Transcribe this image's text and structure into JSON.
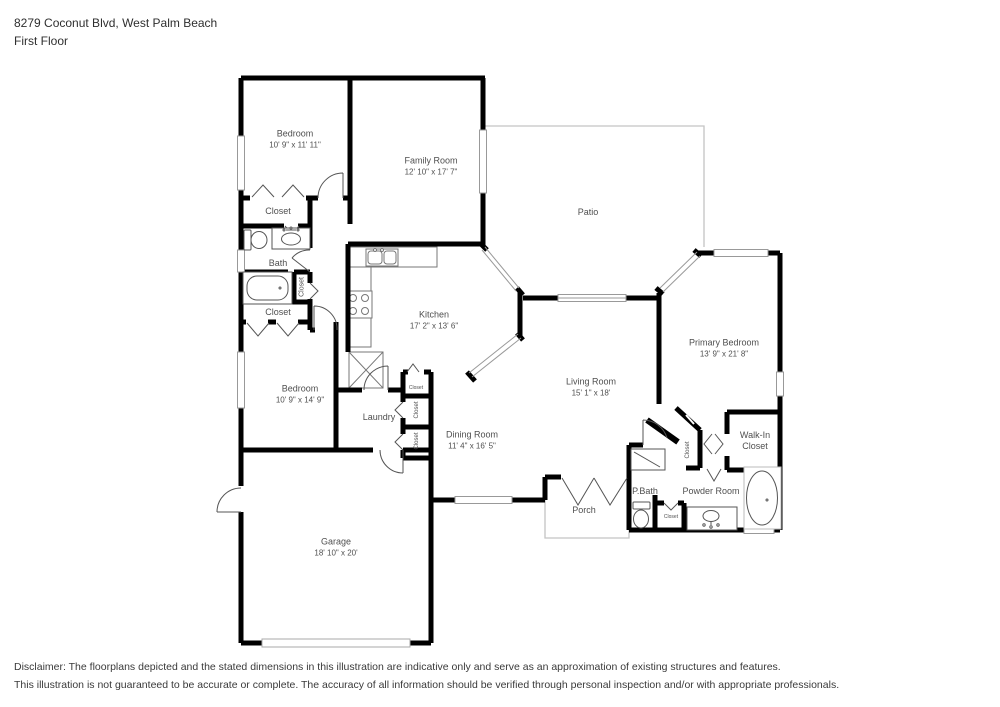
{
  "header": {
    "address": "8279 Coconut Blvd, West Palm Beach",
    "floor": "First Floor"
  },
  "rooms": {
    "bedroom1": {
      "name": "Bedroom",
      "dims": "10' 9\" x 11' 11\""
    },
    "family_room": {
      "name": "Family Room",
      "dims": "12' 10\" x 17' 7\""
    },
    "patio": {
      "name": "Patio"
    },
    "closet_bedroom1": {
      "name": "Closet"
    },
    "bath": {
      "name": "Bath"
    },
    "closet_tub": {
      "name": "Closet"
    },
    "closet_hall": {
      "name": "Closet"
    },
    "kitchen": {
      "name": "Kitchen",
      "dims": "17' 2\" x 13' 6\""
    },
    "bedroom2": {
      "name": "Bedroom",
      "dims": "10' 9\" x 14' 9\""
    },
    "laundry": {
      "name": "Laundry"
    },
    "closet_kitchen": {
      "name": "Closet"
    },
    "closet_laundry1": {
      "name": "Closet"
    },
    "closet_laundry2": {
      "name": "Closet"
    },
    "dining_room": {
      "name": "Dining Room",
      "dims": "11' 4\" x 16' 5\""
    },
    "living_room": {
      "name": "Living Room",
      "dims": "15' 1\" x 18'"
    },
    "primary_bedroom": {
      "name": "Primary Bedroom",
      "dims": "13' 9\" x 21' 8\""
    },
    "walk_in_closet": {
      "name": "Walk-In Closet"
    },
    "closet_vestibule": {
      "name": "Closet"
    },
    "p_bath": {
      "name": "P.Bath"
    },
    "powder_room": {
      "name": "Powder Room"
    },
    "closet_powder": {
      "name": "Closet"
    },
    "porch": {
      "name": "Porch"
    },
    "garage": {
      "name": "Garage",
      "dims": "18' 10\" x 20'"
    }
  },
  "footer": {
    "line1": "Disclaimer: The floorplans depicted and the stated dimensions in this illustration are indicative only and serve as an approximation of existing structures and features.",
    "line2": "This illustration is not guaranteed to be accurate or complete. The accuracy of all information should be verified through personal inspection and/or with appropriate professionals."
  },
  "icons": {
    "toilet-icon": "tank+bowl shape",
    "sink-icon": "vanity oval",
    "bathtub-icon": "rounded tub",
    "freestanding-tub-icon": "oval tub",
    "shower-icon": "square with diagonal",
    "stove-icon": "4 burners",
    "kitchen-sink-icon": "double basin",
    "washer-icon": "box with X",
    "door-arc-icon": "quarter-circle swing",
    "window-icon": "white gap in wall"
  },
  "colors": {
    "wall": "#000000",
    "outdoor_outline": "#c4c4c4",
    "window_line": "#999999",
    "door_line": "#555555",
    "label_text": "#4f4f4f"
  }
}
